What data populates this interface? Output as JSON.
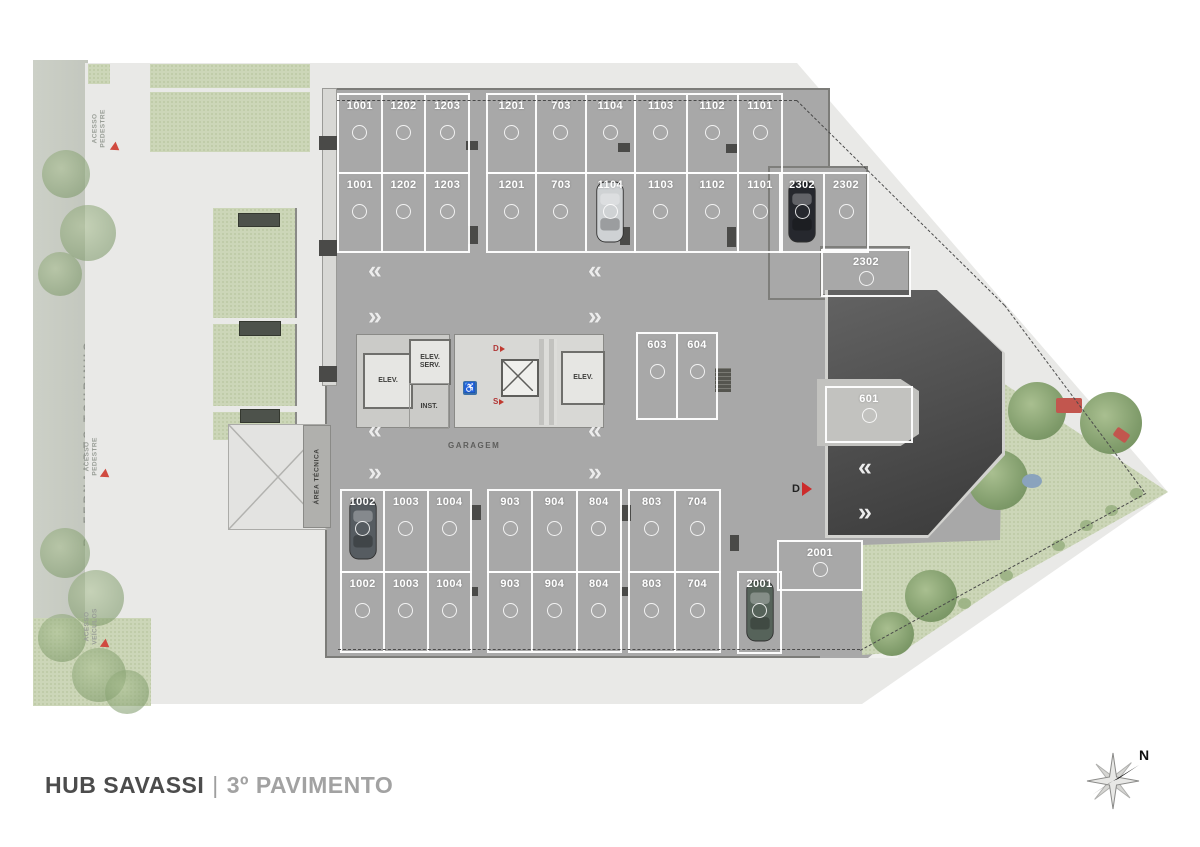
{
  "title": {
    "project": "HUB SAVASSI",
    "separator": "|",
    "floor": "3º PAVIMENTO"
  },
  "street": {
    "name": "R. FERNANDES TOURINHO"
  },
  "site_labels": {
    "access_pedestrian_top": "ACESSO PEDESTRE",
    "access_pedestrian_mid": "ACESSO PEDESTRE",
    "access_vehicles": "ACESSO VEÍCULOS"
  },
  "compass": {
    "north_label": "N"
  },
  "plan": {
    "garage_label": "GARAGEM",
    "technical_area_label": "ÁREA TÉCNICA",
    "exit_marker": "D",
    "core": {
      "elevator_left": "ELEV.",
      "elevator_service": "ELEV. SERV.",
      "installations": "INST.",
      "elevator_right": "ELEV.",
      "stair_down_label": "D",
      "stair_up_label": "S"
    },
    "icons": {
      "chevron_left": "«",
      "chevron_right": "»",
      "wheelchair": "♿"
    }
  },
  "parking": {
    "row_a_groups": [
      {
        "labels": [
          "1001",
          "1202",
          "1203"
        ]
      },
      {
        "labels": [
          "1201",
          "703",
          "1104"
        ]
      },
      {
        "labels": [
          "1103",
          "1102"
        ]
      },
      {
        "labels": [
          "1101"
        ]
      }
    ],
    "row_b_groups": [
      {
        "labels": [
          "1001",
          "1202",
          "1203"
        ]
      },
      {
        "labels": [
          "1201",
          "703",
          "1104"
        ],
        "car_at": 2,
        "car_color": "#cfd2d4"
      },
      {
        "labels": [
          "1103",
          "1102"
        ]
      },
      {
        "labels": [
          "1101"
        ]
      }
    ],
    "block_2302": {
      "labels": [
        "2302",
        "2302"
      ],
      "car_at": 0,
      "car_color": "#26282e"
    },
    "spot_2302_h": {
      "labels": [
        "2302"
      ]
    },
    "mid_pair": {
      "labels": [
        "603",
        "604"
      ]
    },
    "spot_601": {
      "labels": [
        "601"
      ]
    },
    "row_c_groups": [
      {
        "labels": [
          "1002",
          "1003",
          "1004"
        ],
        "car_at": 0,
        "car_color": "#565c61"
      },
      {
        "labels": [
          "903",
          "904",
          "804"
        ]
      },
      {
        "labels": [
          "803",
          "704"
        ]
      }
    ],
    "row_d_groups": [
      {
        "labels": [
          "1002",
          "1003",
          "1004"
        ]
      },
      {
        "labels": [
          "903",
          "904",
          "804"
        ]
      },
      {
        "labels": [
          "803",
          "704"
        ]
      }
    ],
    "spot_2001_v": {
      "labels": [
        "2001"
      ],
      "car_at": 0,
      "car_color": "#56635a"
    },
    "spot_2001_h": {
      "labels": [
        "2001"
      ]
    }
  }
}
